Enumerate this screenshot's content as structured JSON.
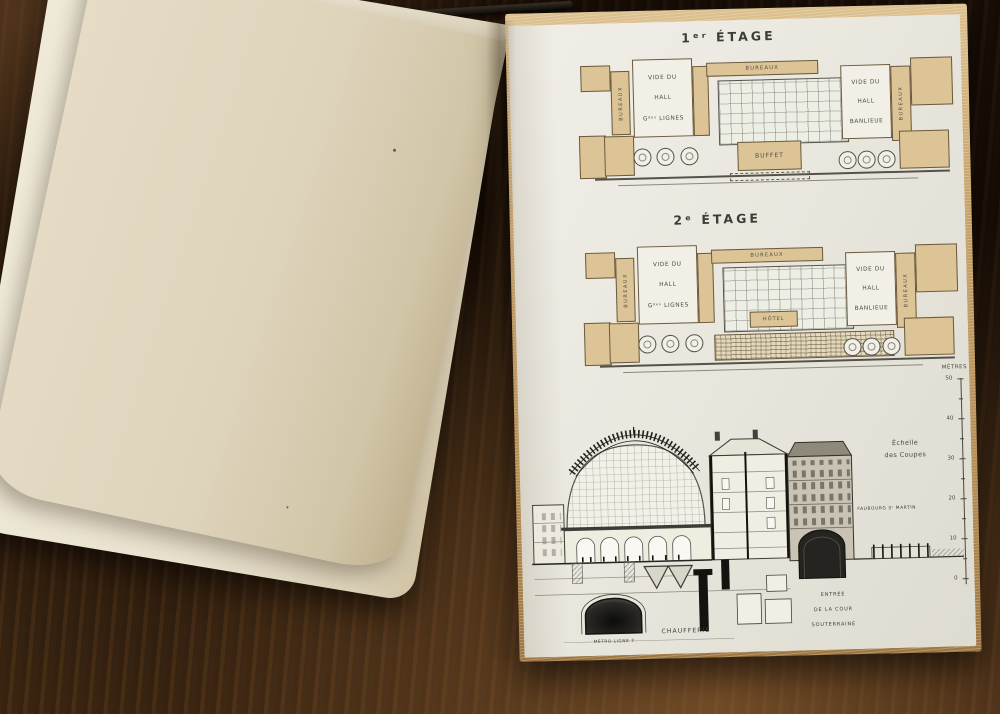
{
  "palette": {
    "wood_brown": "#36210f",
    "paper_cream": "#e6dcc6",
    "paper_white": "#e9e7de",
    "plan_tan": "#dcc496",
    "ink": "#3f3c35"
  },
  "plate": {
    "floor1_title": "1ᵉʳ ÉTAGE",
    "floor2_title": "2ᵉ ÉTAGE"
  },
  "floor1": {
    "bureaux_top": "BUREAUX",
    "bureaux_left": "BUREAUX",
    "bureaux_right": "BUREAUX",
    "hall_left_l1": "VIDE DU",
    "hall_left_l2": "HALL",
    "hall_left_l3": "Gᵈᵉˢ LIGNES",
    "hall_right_l1": "VIDE DU",
    "hall_right_l2": "HALL",
    "hall_right_l3": "BANLIEUE",
    "center_room": "BUFFET"
  },
  "floor2": {
    "bureaux_top": "BUREAUX",
    "bureaux_left": "BUREAUX",
    "bureaux_right": "BUREAUX",
    "hall_left_l1": "VIDE DU",
    "hall_left_l2": "HALL",
    "hall_left_l3": "Gᵈᵉˢ LIGNES",
    "hall_right_l1": "VIDE DU",
    "hall_right_l2": "HALL",
    "hall_right_l3": "BANLIEUE",
    "center_room": "HÔTEL"
  },
  "section": {
    "caption_l1": "Échelle",
    "caption_l2": "des Coupes",
    "scale_unit": "MÈTRES",
    "scale_ticks": [
      "50",
      "40",
      "30",
      "20",
      "10",
      "0"
    ],
    "street_label": "FAUBOURG Sᵗ MARTIN",
    "entrance_l1": "ENTRÉE",
    "entrance_l2": "DE LA COUR",
    "entrance_l3": "SOUTERRAINE",
    "boiler_label": "CHAUFFERIE",
    "metro_label": "MÉTRO LIGNE 7"
  }
}
